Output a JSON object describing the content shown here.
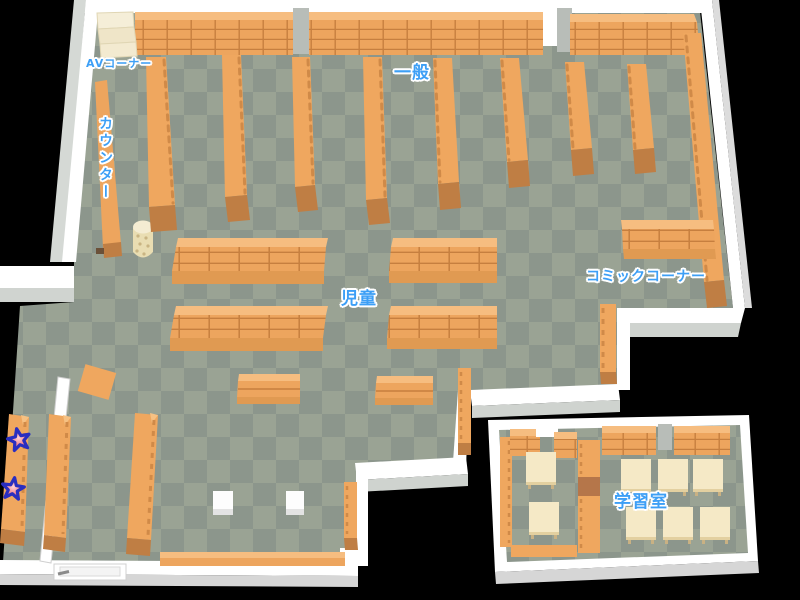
{
  "map": {
    "type": "library-floor-map",
    "areas": [
      {
        "id": "av-corner",
        "label": "AVコーナー"
      },
      {
        "id": "general",
        "label": "一般"
      },
      {
        "id": "counter",
        "label": "カウンター",
        "orientation": "vertical"
      },
      {
        "id": "children",
        "label": "児童"
      },
      {
        "id": "comic-corner",
        "label": "コミックコーナー"
      },
      {
        "id": "study-room",
        "label": "学習室"
      }
    ],
    "markers": [
      {
        "id": "star-marker-1",
        "shape": "star"
      },
      {
        "id": "star-marker-2",
        "shape": "star"
      }
    ],
    "colors": {
      "background": "#000000",
      "floor_light": "#9aa394",
      "floor_dark": "#8c968c",
      "shelf": "#efa75f",
      "shelf_line": "#c67f3f",
      "shelf_top": "#f6bd80",
      "shelf_front": "#e09a52",
      "shelf_cap": "#bf7e44",
      "wall": "#ffffff",
      "wall_shadow": "#cfd3cf",
      "table_cream": "#f5e9c6",
      "av_table_cream": "#f3ecd4",
      "label_text": "#3d9ff6",
      "label_outline": "#ffffff",
      "star_fill": "#f2858f",
      "star_outline": "#2a2ec0"
    }
  }
}
